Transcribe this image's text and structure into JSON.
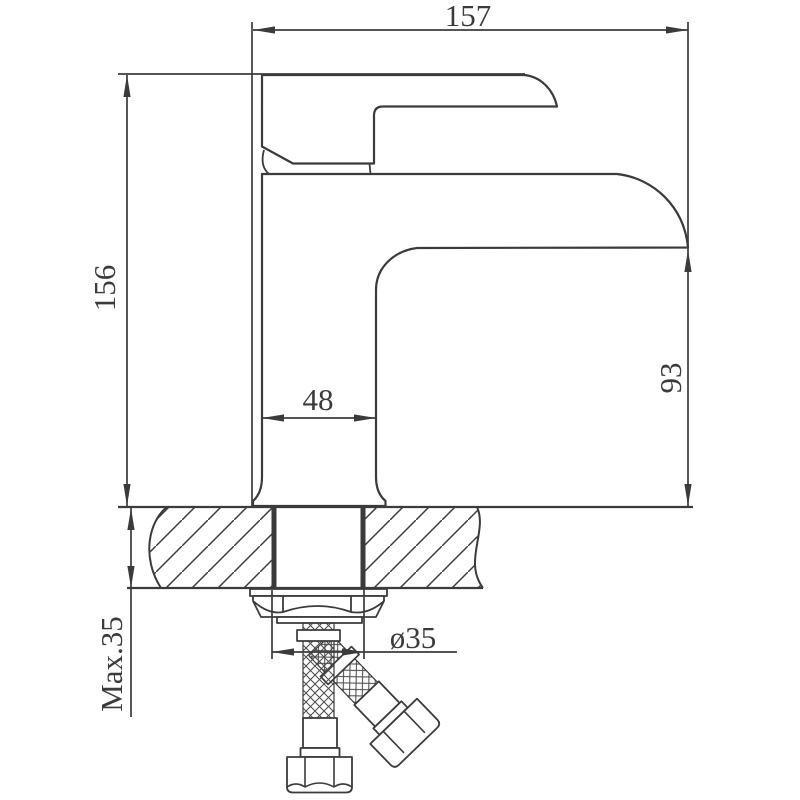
{
  "drawing": {
    "type": "faucet-installation-technical-drawing",
    "dimensions": {
      "top_width": "157",
      "total_height": "156",
      "spout_height": "93",
      "base_width": "48",
      "max_mount_thickness": "Max.35",
      "hole_diameter": "ø35"
    },
    "colors": {
      "line": "#3b3b3b",
      "background": "#ffffff"
    }
  }
}
